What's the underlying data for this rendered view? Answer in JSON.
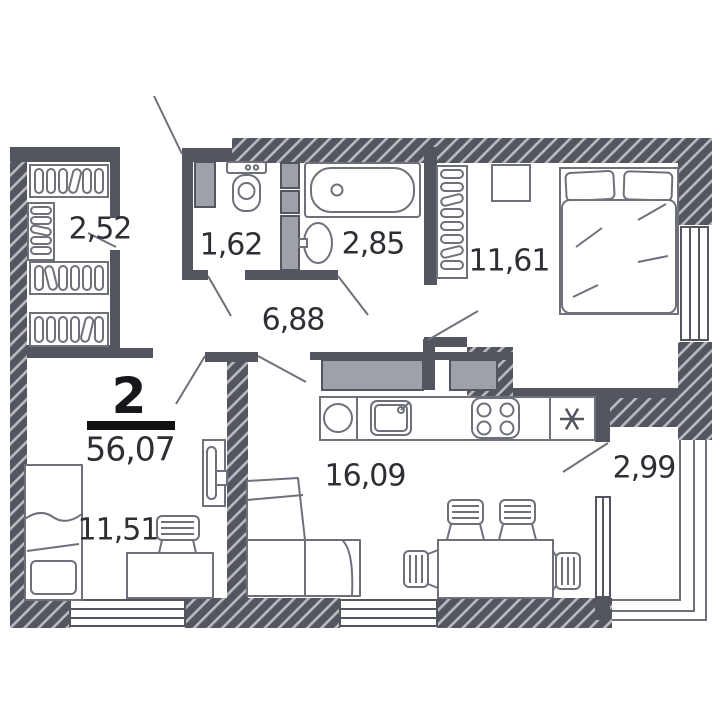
{
  "floor_plan": {
    "apartment": {
      "rooms_label": "2",
      "total_area": "56,07"
    },
    "rooms": [
      {
        "name": "wardrobe",
        "area": "2,52"
      },
      {
        "name": "wc",
        "area": "1,62"
      },
      {
        "name": "bathroom",
        "area": "2,85"
      },
      {
        "name": "bedroom",
        "area": "11,61"
      },
      {
        "name": "hallway",
        "area": "6,88"
      },
      {
        "name": "kitchen-living-room",
        "area": "16,09"
      },
      {
        "name": "balcony",
        "area": "2,99"
      },
      {
        "name": "bedroom-2",
        "area": "11,51"
      }
    ],
    "colors": {
      "wall": "#54565f",
      "hatch_line": "#b9bac0",
      "shaft_fill": "#9fa1a8",
      "furniture_line": "#6e707a",
      "label_text": "#2e2f34",
      "apartment_text": "#17171b"
    }
  }
}
